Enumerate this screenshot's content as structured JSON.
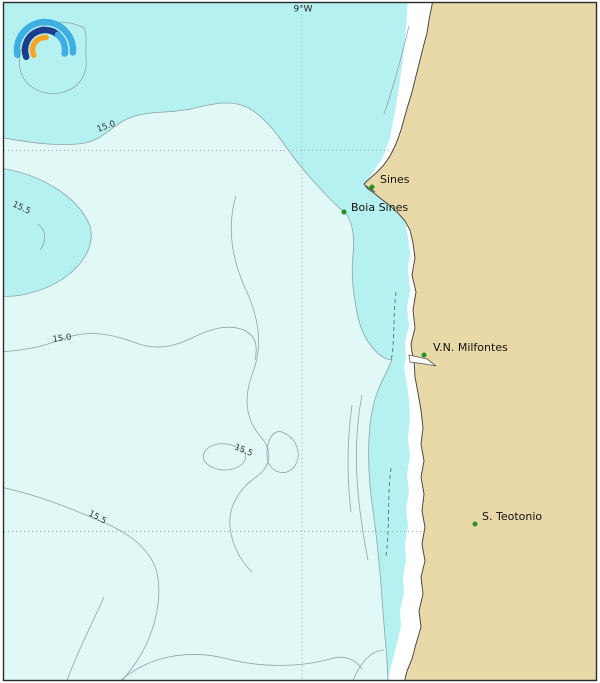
{
  "map": {
    "meridian_label": "9°W",
    "contour_labels": [
      {
        "text": "15.0"
      },
      {
        "text": "15.5"
      },
      {
        "text": "15.0"
      },
      {
        "text": "15.5"
      },
      {
        "text": "15.5"
      }
    ],
    "places": [
      {
        "name": "Sines"
      },
      {
        "name": "Boia Sines"
      },
      {
        "name": "V.N. Milfontes"
      },
      {
        "name": "S. Teotonio"
      }
    ],
    "colors": {
      "sea_band_cool": "#B5F1F0",
      "sea_band_warm": "#E0F9F6",
      "coastal_nodata": "#FFFFFF",
      "land": "#EAD9A8",
      "contour_line": "#8FA3A8",
      "dashed_contour": "#4B8696",
      "coastline": "#4A4A4A",
      "grid_line": "#9AAFB4",
      "place_marker": "#1E9C1E"
    },
    "logo": {
      "light_blue": "#3FAEE0",
      "dark_blue": "#1C3D8C",
      "orange": "#F5A623"
    }
  }
}
